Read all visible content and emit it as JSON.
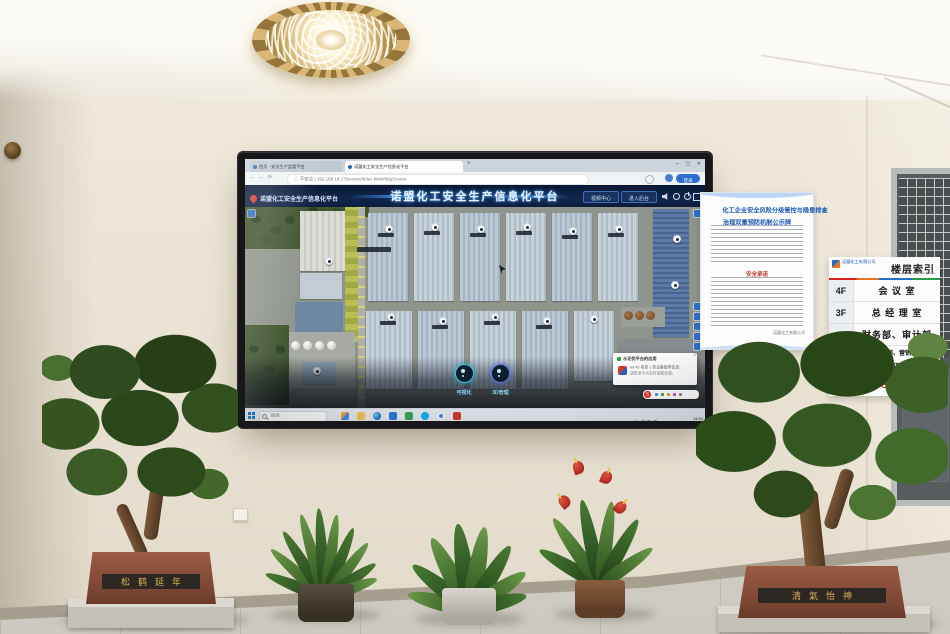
{
  "scene": {
    "room": "office-lobby",
    "pot_inscriptions": {
      "left": "松鹤延年",
      "right": "清氣怡神"
    }
  },
  "screen": {
    "browser": {
      "tabs": [
        {
          "title": "首页 - 安全生产监管平台"
        },
        {
          "title": "诺盟化工安全生产信息化平台"
        }
      ],
      "new_tab": "+",
      "window_controls": {
        "minimize": "─",
        "maximize": "▢",
        "close": "✕"
      },
      "nav_glyphs": "←  →  ⟳",
      "security_label": "不安全",
      "url": "192.168.18.17/screen/index.html#/bigScreen",
      "profile_button": "登录"
    },
    "platform": {
      "logo_title": "诺盟化工安全生产信息化平台",
      "title": "诺盟化工安全生产信息化平台",
      "video_center_button": "视频中心",
      "backend_button": "进入后台"
    },
    "dock": {
      "visual_button": "可视化",
      "manage_button": "3D管理"
    },
    "toast": {
      "title": "水无忧平台的应用",
      "line1": "09:45 收到 1 条设备报警信息，",
      "line2": "请登录平台及时查看处理。",
      "close": "✕",
      "sogou_letter": "S"
    },
    "taskbar": {
      "search_placeholder": "搜索",
      "tray_time": "14:54",
      "tray_date": "2021/11/8"
    }
  },
  "signs": {
    "poster": {
      "title_line1": "化工企业安全风险分级管控与隐患排查",
      "title_line2": "治理双重预防机制公示牌",
      "section_heading": "安全承诺",
      "footer": "诺盟化工有限公司"
    },
    "floor_directory": {
      "company": "诺盟化工有限公司",
      "title": "楼层索引",
      "subtitle": "Floor Index",
      "rows": [
        {
          "floor": "4F",
          "label": "会 议 室"
        },
        {
          "floor": "3F",
          "label": "总 经 理 室"
        },
        {
          "floor": "2F",
          "label": "财务部、审计部"
        },
        {
          "floor": "1F",
          "label": "行政部、营销部",
          "label2": "采购部、安环部、总经办"
        }
      ]
    }
  }
}
